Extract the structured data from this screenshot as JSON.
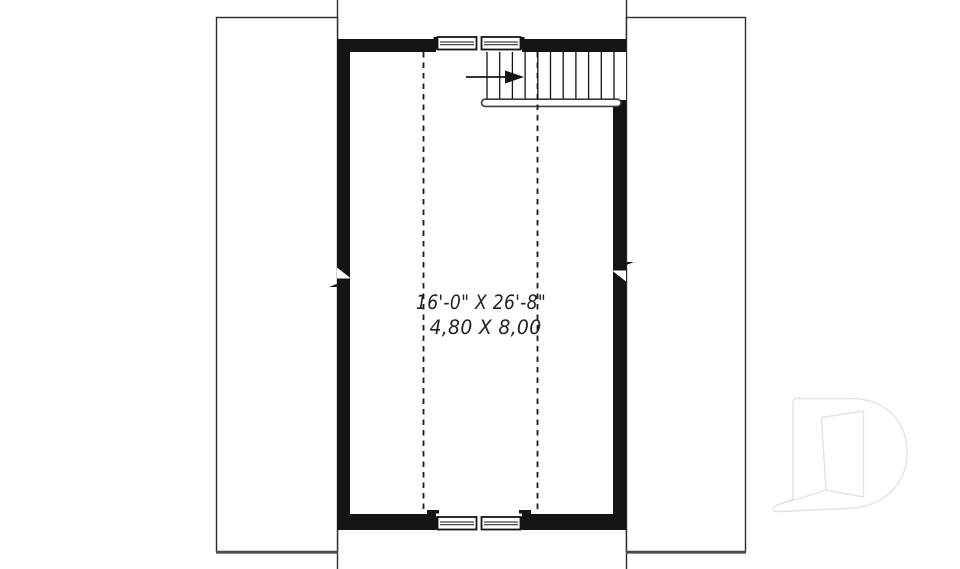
{
  "page": {
    "type": "architectural-floor-plan",
    "background": "#ffffff"
  },
  "plan": {
    "room": {
      "dimension_imperial": "16'-0\" X 26'-8\"",
      "dimension_metric": "4,80 X 8,00"
    }
  },
  "colors": {
    "wall": "#141414",
    "outline": "#2b2b2b",
    "panel_bottom_edge": "#4a4a4a",
    "dashed_line": "#1a1a1a",
    "handrail_outline": "#3d3d3d",
    "text": "#222222",
    "logo_outline": "#e3e3e3"
  },
  "icons": {
    "stair_direction_arrow": "arrow-right",
    "logo": "letter-d-open-door"
  }
}
